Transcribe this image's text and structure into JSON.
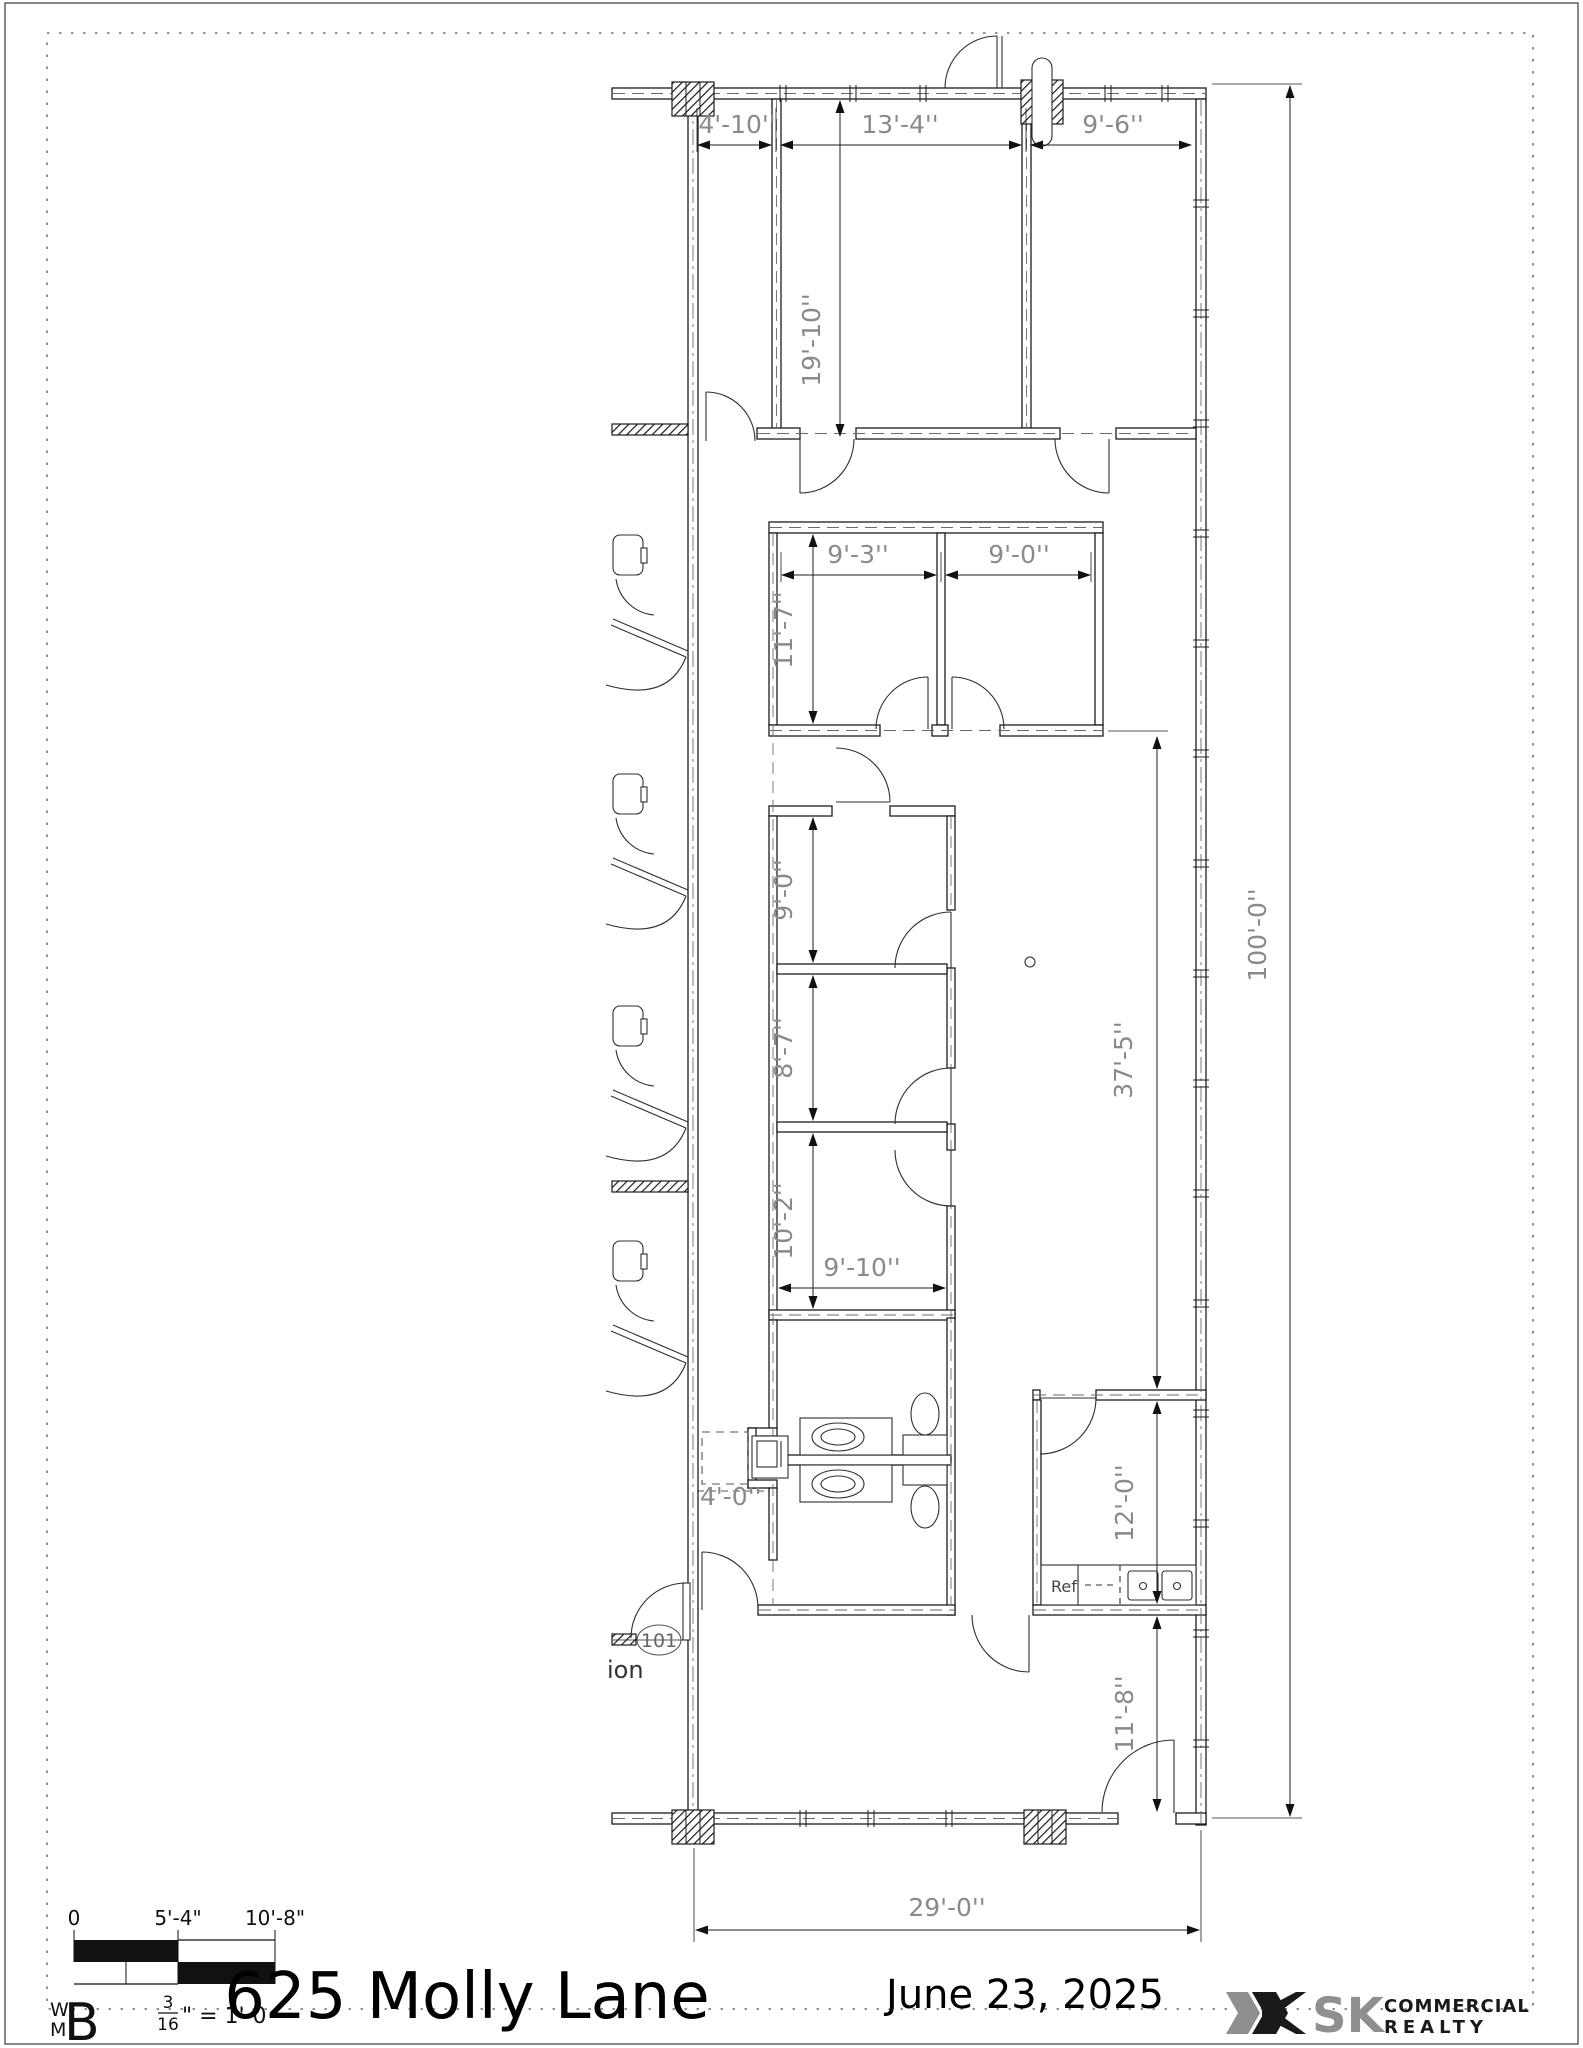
{
  "title_block": {
    "title": "625 Molly Lane",
    "date": "June 23, 2025",
    "scale_fraction_num": "3",
    "scale_fraction_den": "16",
    "scale_suffix": "\" = 1'-0 '",
    "scale_ticks": [
      "0",
      "5'-4\"",
      "10'-8\""
    ],
    "monogram_w": "W",
    "monogram_m": "M",
    "monogram_b": "B"
  },
  "branding": {
    "name_bold": "SK",
    "line1": "COMMERCIAL",
    "line2": "REALTY",
    "accent_gray": "#8f8f8f",
    "accent_dark": "#1a1a1a"
  },
  "plan": {
    "room_tag": "101",
    "clipped_label": "ion",
    "appliance_label": "Ref",
    "dims": {
      "top_widths": [
        "4'-10''",
        "13'-4''",
        "9'-6''"
      ],
      "room_depth_top": "19'-10''",
      "mid_widths": [
        "9'-3''",
        "9'-0''"
      ],
      "mid_depth": "11'-7''",
      "left_rooms": [
        "9'-0''",
        "8'-7''",
        "10'-2''"
      ],
      "left_rooms_width": "9'-10''",
      "open_area": "37'-5''",
      "overall_height": "100'-0''",
      "alcove": "4'-0''",
      "break_room": "12'-0''",
      "rear_strip": "11'-8''",
      "overall_width": "29'-0''"
    }
  }
}
